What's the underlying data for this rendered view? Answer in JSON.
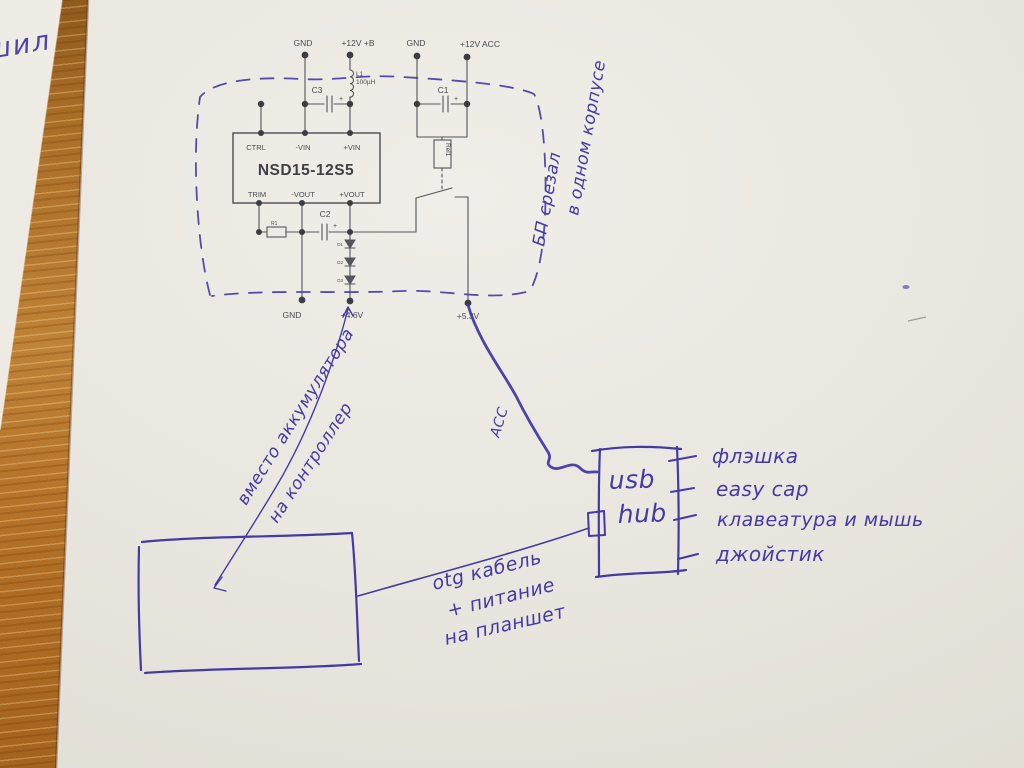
{
  "photo": {
    "description": "hand-annotated power-supply schematic on paper over a wooden desk",
    "ink_color": "#453aa4",
    "print_color": "#4a4a50",
    "paper_color": "#e9e6df",
    "wood_color": "#b5762f"
  },
  "schematic": {
    "module": "NSD15-12S5",
    "pins": {
      "ctrl": "CTRL",
      "vin_neg": "-VIN",
      "vin_pos": "+VIN",
      "trim": "TRIM",
      "vout_neg": "-VOUT",
      "vout_pos": "+VOUT"
    },
    "terminals": {
      "gnd1": "GND",
      "b12": "+12V +B",
      "gnd2": "GND",
      "acc12": "+12V ACC",
      "gnd_out": "GND",
      "v46": "+4.6V",
      "v53": "+5.3V"
    },
    "components": {
      "c1": "C1",
      "c2": "C2",
      "c3": "C3",
      "l1": "L1",
      "l1_value": "100µH",
      "r1": "R1",
      "rel1": "Rel1",
      "d1": "D1",
      "d2": "D2",
      "d3": "D3",
      "plus": "+"
    }
  },
  "annotations": {
    "psu_line1": "БП срезал",
    "psu_line2": "в одном корпусе",
    "battery_line1": "вместо аккумулятора",
    "battery_line2": "на контроллер",
    "acc": "АСС",
    "hub_line1": "usb",
    "hub_line2": "hub",
    "hub_ports": [
      "флэшка",
      "easy cap",
      "клавеатура и мышь",
      "джойстик"
    ],
    "otg_line1": "otg кабель",
    "otg_line2": "+ питание",
    "otg_line3": "на планшет",
    "corner_note": "шил"
  }
}
